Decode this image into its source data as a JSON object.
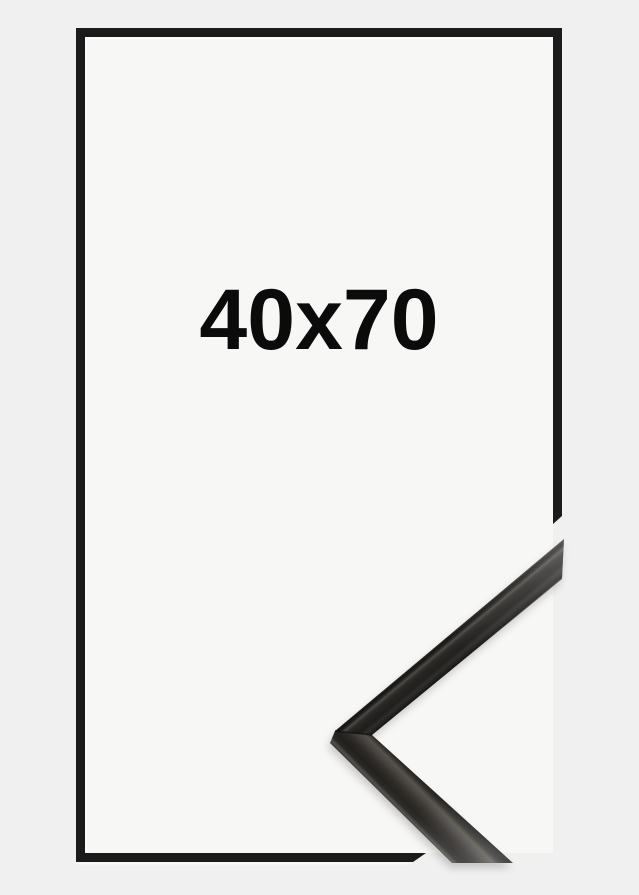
{
  "frame_preview": {
    "size_label": "40x70",
    "colors": {
      "background": "#f0f0f1",
      "inner_area": "#f7f7f6",
      "outline": "#1c1b1b",
      "label_text": "#0b0b0b",
      "moulding_body": "#23211f",
      "moulding_highlight": "#55524e",
      "moulding_edge": "#0e0d0c"
    }
  }
}
